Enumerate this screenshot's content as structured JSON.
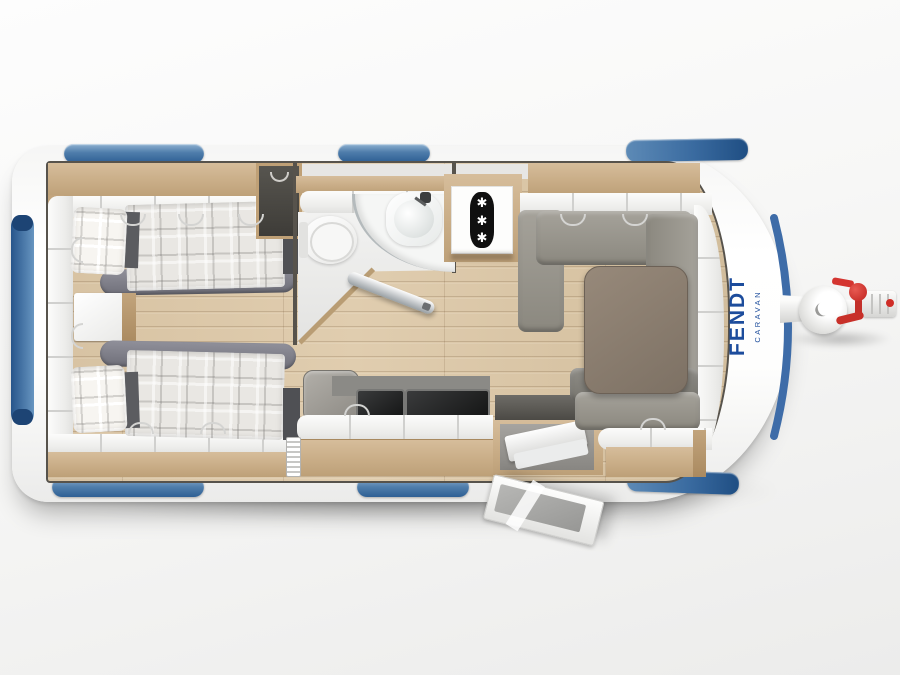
{
  "brand": {
    "name": "FENDT",
    "sub": "CARAVAN",
    "color": "#1c4c9c"
  },
  "fridge": {
    "snowflakes": [
      "✱",
      "✱",
      "✱"
    ]
  },
  "palette": {
    "window_blue": "#3a6ba0",
    "trim_blue": "#3e6ca8",
    "body_white": "#fbfbfa",
    "cabinet_wood": "#c9ad87",
    "floor_wood": "#d9c5a7",
    "upholstery_gray": "#98958d",
    "bedding_plaid": "#e9e7e3",
    "hitch_red": "#cf2d27",
    "appliance_black": "#131414"
  }
}
